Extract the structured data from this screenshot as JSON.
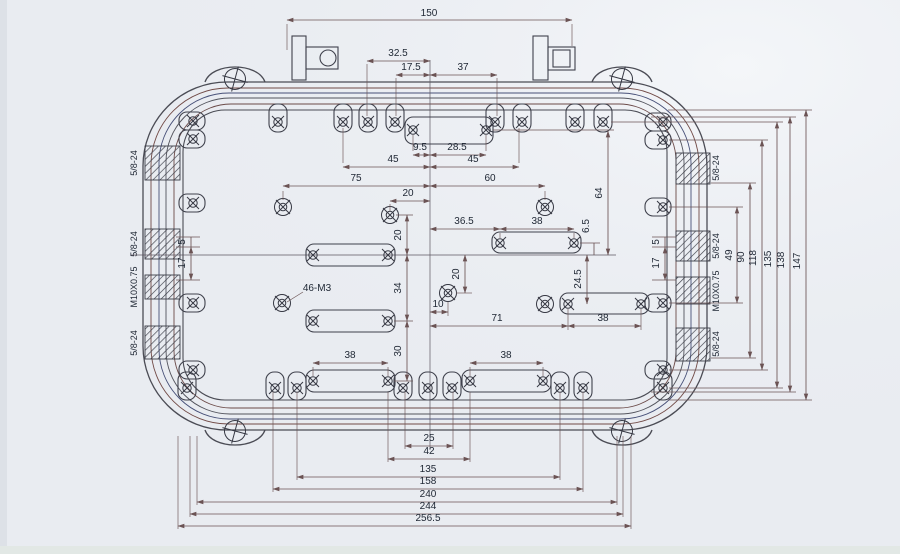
{
  "drawing": {
    "dimensions": {
      "t150": "150",
      "t32_5": "32.5",
      "t17_5": "17.5",
      "t37": "37",
      "t9_5": "9.5",
      "t28_5": "28.5",
      "t45l": "45",
      "t45r": "45",
      "t75": "75",
      "t60": "60",
      "t20a": "20",
      "t20b": "20",
      "t34": "34",
      "t30": "30",
      "t36_5": "36.5",
      "t38a": "38",
      "t64": "64",
      "t6_5": "6.5",
      "t24_5": "24.5",
      "t20c": "20",
      "t10": "10",
      "t71": "71",
      "t38b": "38",
      "t46m3": "46-M3",
      "t38c": "38",
      "t38d": "38",
      "t25": "25",
      "t42": "42",
      "t135": "135",
      "t158": "158",
      "t240": "240",
      "t244": "244",
      "t256_5": "256.5",
      "t49": "49",
      "t90": "90",
      "t118": "118",
      "t135r": "135",
      "t138": "138",
      "t147": "147",
      "t5l": "5",
      "t17l": "17",
      "t5r": "5",
      "t17r": "17"
    },
    "threads": {
      "left": [
        "5/8-24",
        "5/8-24",
        "M10X0.75",
        "5/8-24"
      ],
      "right": [
        "5/8-24",
        "5/8-24",
        "M10X0.75",
        "5/8-24"
      ]
    }
  }
}
